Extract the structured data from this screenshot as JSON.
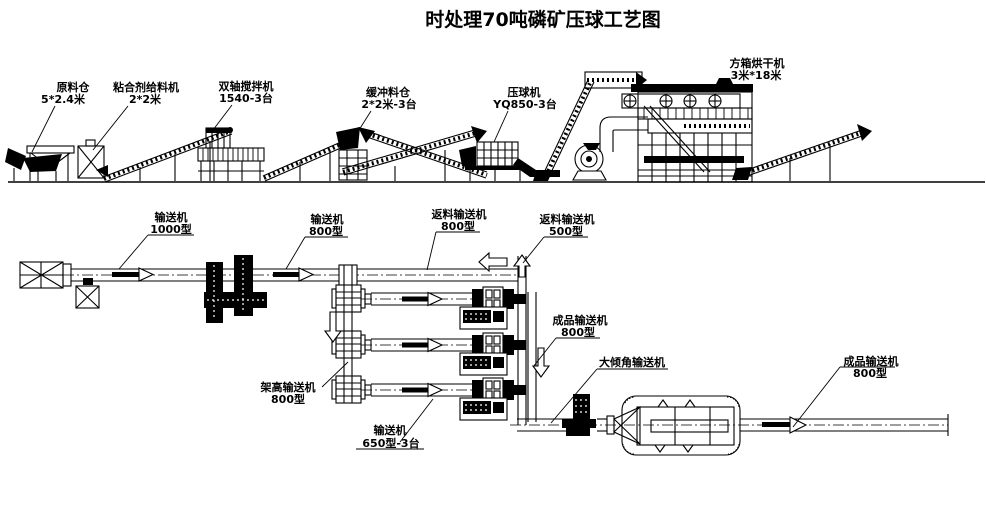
{
  "title": "时处理70吨磷矿压球工艺图",
  "colors": {
    "ink": "#000000",
    "background": "#ffffff"
  },
  "labels_top": [
    {
      "line1": "原料仓",
      "line2": "5*2.4米"
    },
    {
      "line1": "粘合剂给料机",
      "line2": "2*2米"
    },
    {
      "line1": "双轴搅拌机",
      "line2": "1540-3台"
    },
    {
      "line1": "缓冲料仓",
      "line2": "2*2米-3台"
    },
    {
      "line1": "压球机",
      "line2": "YQ850-3台"
    },
    {
      "line1": "方箱烘干机",
      "line2": "3米*18米"
    }
  ],
  "labels_plan": [
    {
      "line1": "输送机",
      "line2": "1000型"
    },
    {
      "line1": "输送机",
      "line2": "800型"
    },
    {
      "line1": "返料输送机",
      "line2": "800型"
    },
    {
      "line1": "返料输送机",
      "line2": "500型"
    },
    {
      "line1": "成品输送机",
      "line2": "800型"
    },
    {
      "line1": "大倾角输送机",
      "line2": ""
    },
    {
      "line1": "架高输送机",
      "line2": "800型"
    },
    {
      "line1": "输送机",
      "line2": "650型-3台"
    },
    {
      "line1": "成品输送机",
      "line2": "800型"
    }
  ]
}
